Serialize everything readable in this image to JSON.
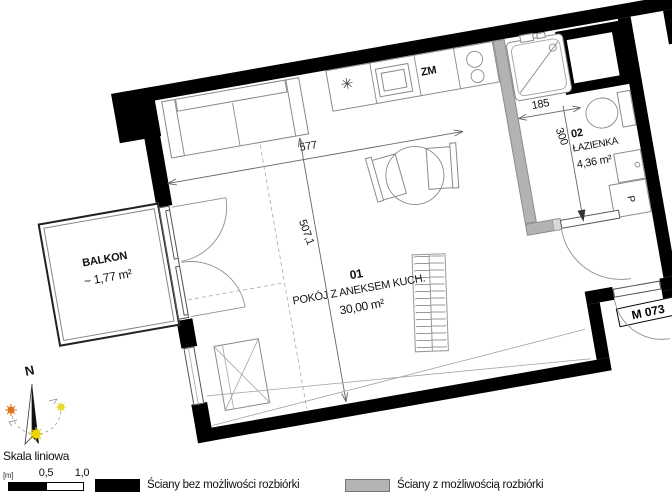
{
  "plan": {
    "apartment_label": "M 073",
    "rooms": [
      {
        "number": "01",
        "name": "POKÓJ Z ANEKSEM KUCH.",
        "area": "30,00 m²"
      },
      {
        "number": "02",
        "name": "ŁAZIENKA",
        "area": "4,36 m²"
      }
    ],
    "balcony": {
      "name": "BALKON",
      "area": "~ 1,77 m²"
    },
    "dimensions": {
      "room_width": "577",
      "room_depth": "507,1",
      "bathroom_width": "185",
      "bathroom_depth": "300"
    },
    "labels": {
      "dishwasher": "ZM",
      "washing_machine": "P",
      "burner_symbol": "✳"
    }
  },
  "compass": {
    "north": "N"
  },
  "scalebar": {
    "title": "Skala liniowa",
    "unit": "[m]",
    "ticks": [
      "0,5",
      "1,0"
    ]
  },
  "legend": {
    "items": [
      {
        "label": "Ściany bez możliwości rozbiórki",
        "color": "#000000"
      },
      {
        "label": "Ściany z możliwością rozbiórki",
        "color": "#b3b3b3"
      }
    ]
  }
}
